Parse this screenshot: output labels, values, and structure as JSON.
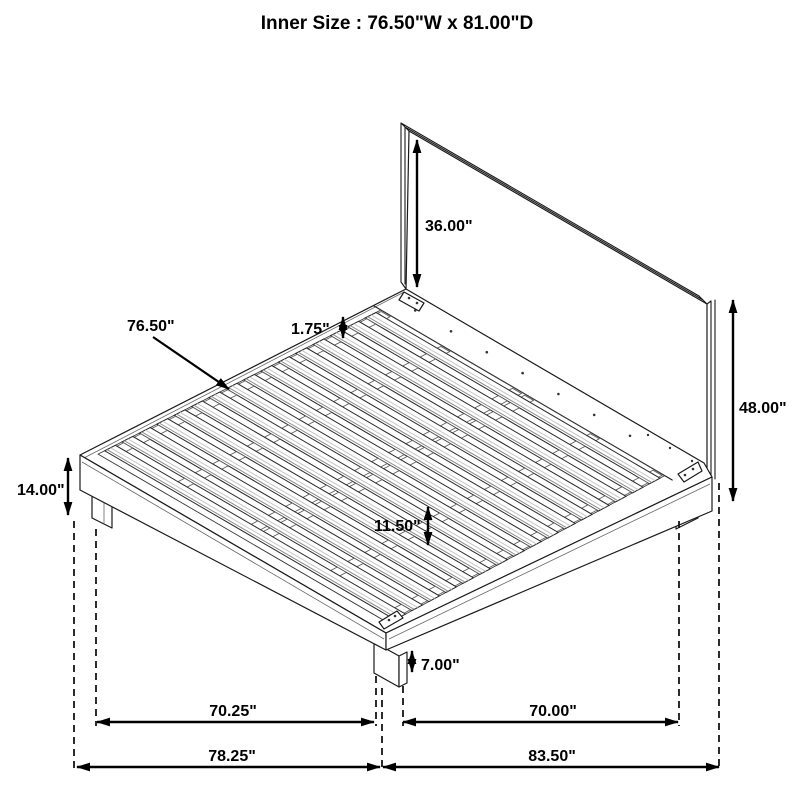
{
  "title": "Inner Size : 76.50\"W x 81.00\"D",
  "dimensions": {
    "headboard_above_platform": "36.00\"",
    "slat_length": "76.50\"",
    "slat_gap": "1.75\"",
    "headboard_total_height": "48.00\"",
    "platform_height": "14.00\"",
    "slat_support_spacing": "11.50\"",
    "leg_height": "7.00\"",
    "front_leg_span": "70.25\"",
    "side_leg_span": "70.00\"",
    "overall_width": "78.25\"",
    "overall_depth": "83.50\""
  }
}
